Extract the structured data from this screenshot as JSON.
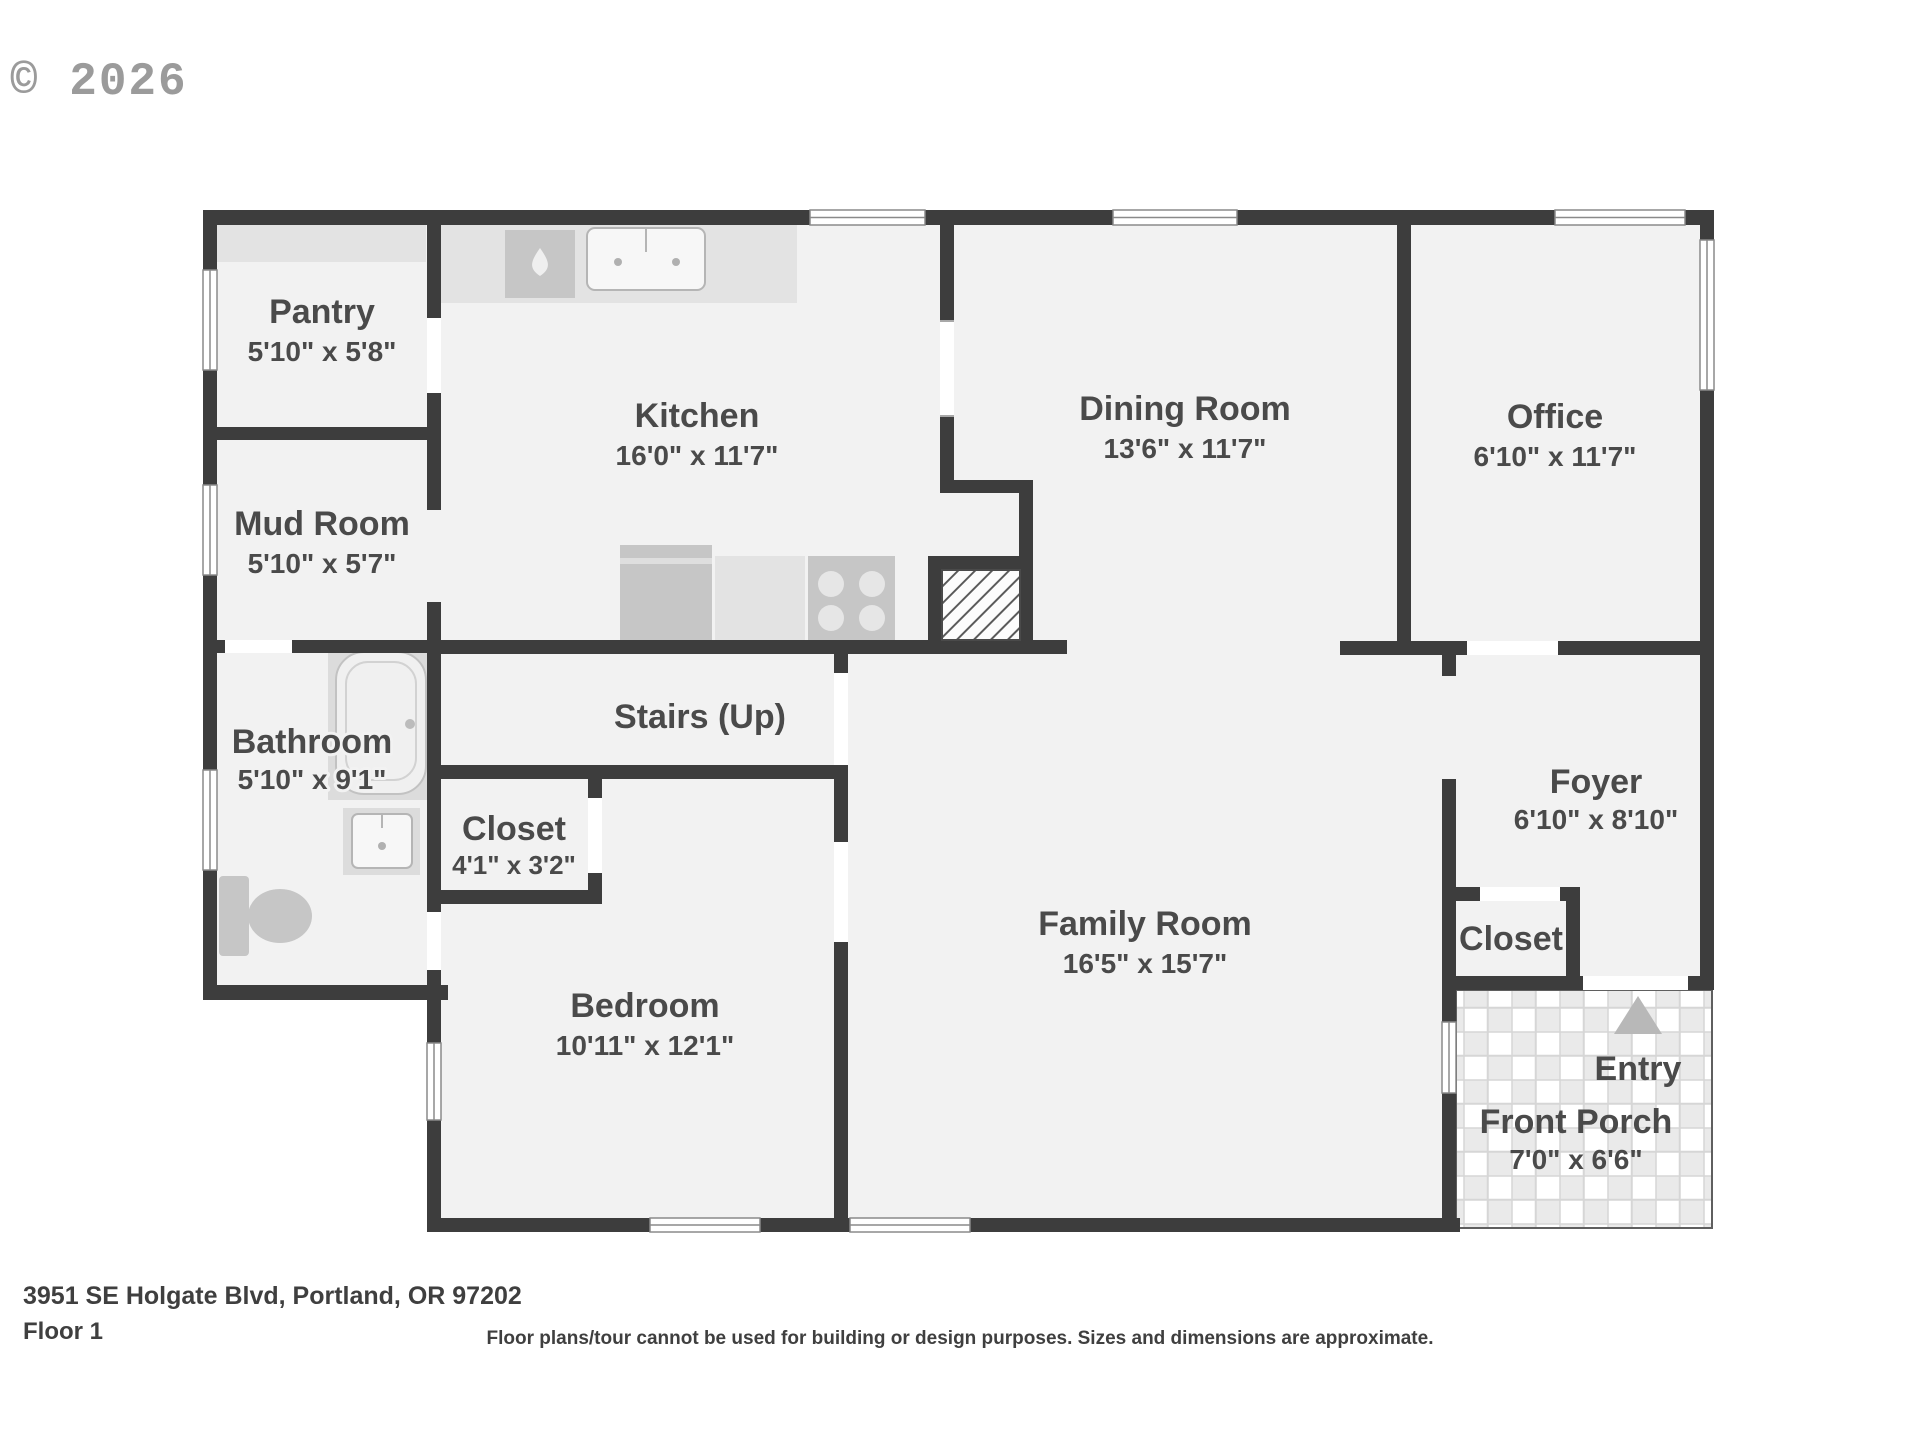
{
  "watermark": "© 2026",
  "footer": {
    "address": "3951 SE Holgate Blvd, Portland, OR 97202",
    "floor": "Floor 1",
    "disclaimer": "Floor plans/tour cannot be used for building or design purposes. Sizes and dimensions are approximate."
  },
  "colors": {
    "wall": "#3d3d3d",
    "floor": "#f2f2f2",
    "counter": "#e3e3e3",
    "appliance": "#c6c6c6",
    "fixture_surround": "#dcdcdc",
    "label_text": "#4a4a4a",
    "watermark_text": "#9b9b9b",
    "entry_arrow": "#b8b8b8"
  },
  "icons": {
    "entry_arrow_icon": "▲",
    "water_drop_icon": "💧"
  },
  "rooms": [
    {
      "id": "pantry",
      "name": "Pantry",
      "dims": "5'10\" x 5'8\""
    },
    {
      "id": "kitchen",
      "name": "Kitchen",
      "dims": "16'0\" x 11'7\""
    },
    {
      "id": "dining",
      "name": "Dining Room",
      "dims": "13'6\" x 11'7\""
    },
    {
      "id": "office",
      "name": "Office",
      "dims": "6'10\" x 11'7\""
    },
    {
      "id": "mudroom",
      "name": "Mud Room",
      "dims": "5'10\" x 5'7\""
    },
    {
      "id": "bathroom",
      "name": "Bathroom",
      "dims": "5'10\" x 9'1\""
    },
    {
      "id": "stairs",
      "name": "Stairs (Up)",
      "dims": ""
    },
    {
      "id": "closet1",
      "name": "Closet",
      "dims": "4'1\" x 3'2\""
    },
    {
      "id": "bedroom",
      "name": "Bedroom",
      "dims": "10'11\" x 12'1\""
    },
    {
      "id": "family",
      "name": "Family Room",
      "dims": "16'5\" x 15'7\""
    },
    {
      "id": "foyer",
      "name": "Foyer",
      "dims": "6'10\" x 8'10\""
    },
    {
      "id": "closet2",
      "name": "Closet",
      "dims": ""
    },
    {
      "id": "entry",
      "name": "Entry",
      "dims": ""
    },
    {
      "id": "porch",
      "name": "Front Porch",
      "dims": "7'0\" x 6'6\""
    }
  ]
}
